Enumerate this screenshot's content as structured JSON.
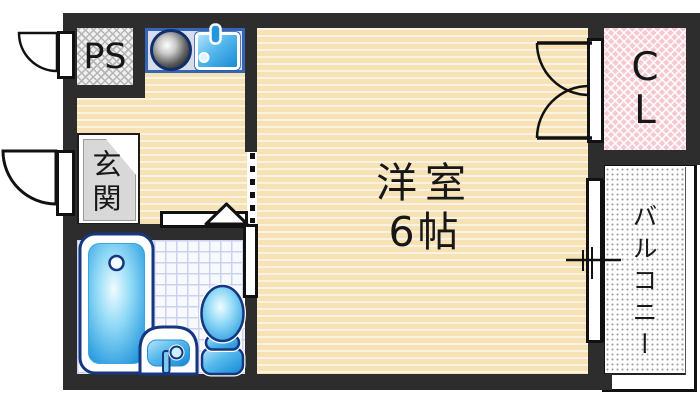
{
  "rooms": {
    "western_room": {
      "name": "洋室",
      "size": "6帖"
    },
    "entrance": {
      "label": "玄関"
    },
    "pipe_space": {
      "label": "PS"
    },
    "closet": {
      "label": "CL",
      "chars": [
        "C",
        "L"
      ]
    },
    "balcony": {
      "label": "バルコニー"
    }
  },
  "fixtures": {
    "kitchen": [
      "gas-burner",
      "kitchen-sink",
      "faucet"
    ],
    "bathroom": [
      "bathtub",
      "washbasin",
      "toilet"
    ]
  },
  "symbols": [
    "entrance-door-swing",
    "ps-door-swing",
    "closet-folding-door",
    "sliding-window",
    "bath-sliding-door",
    "step-triangle-marker"
  ],
  "colors": {
    "wall": "#2d2d2d",
    "floor_base": "#f6e2b4",
    "floor_stripe": "#fdf3da",
    "closet_pink": "#f6c9d2",
    "balcony_dot": "#9e9e9e",
    "bath_tile_grid": "#c9d2ee",
    "fixture_blue": "#1487d2",
    "fixture_outline": "#16377f",
    "kitchen_unit_border": "#3566b6"
  }
}
